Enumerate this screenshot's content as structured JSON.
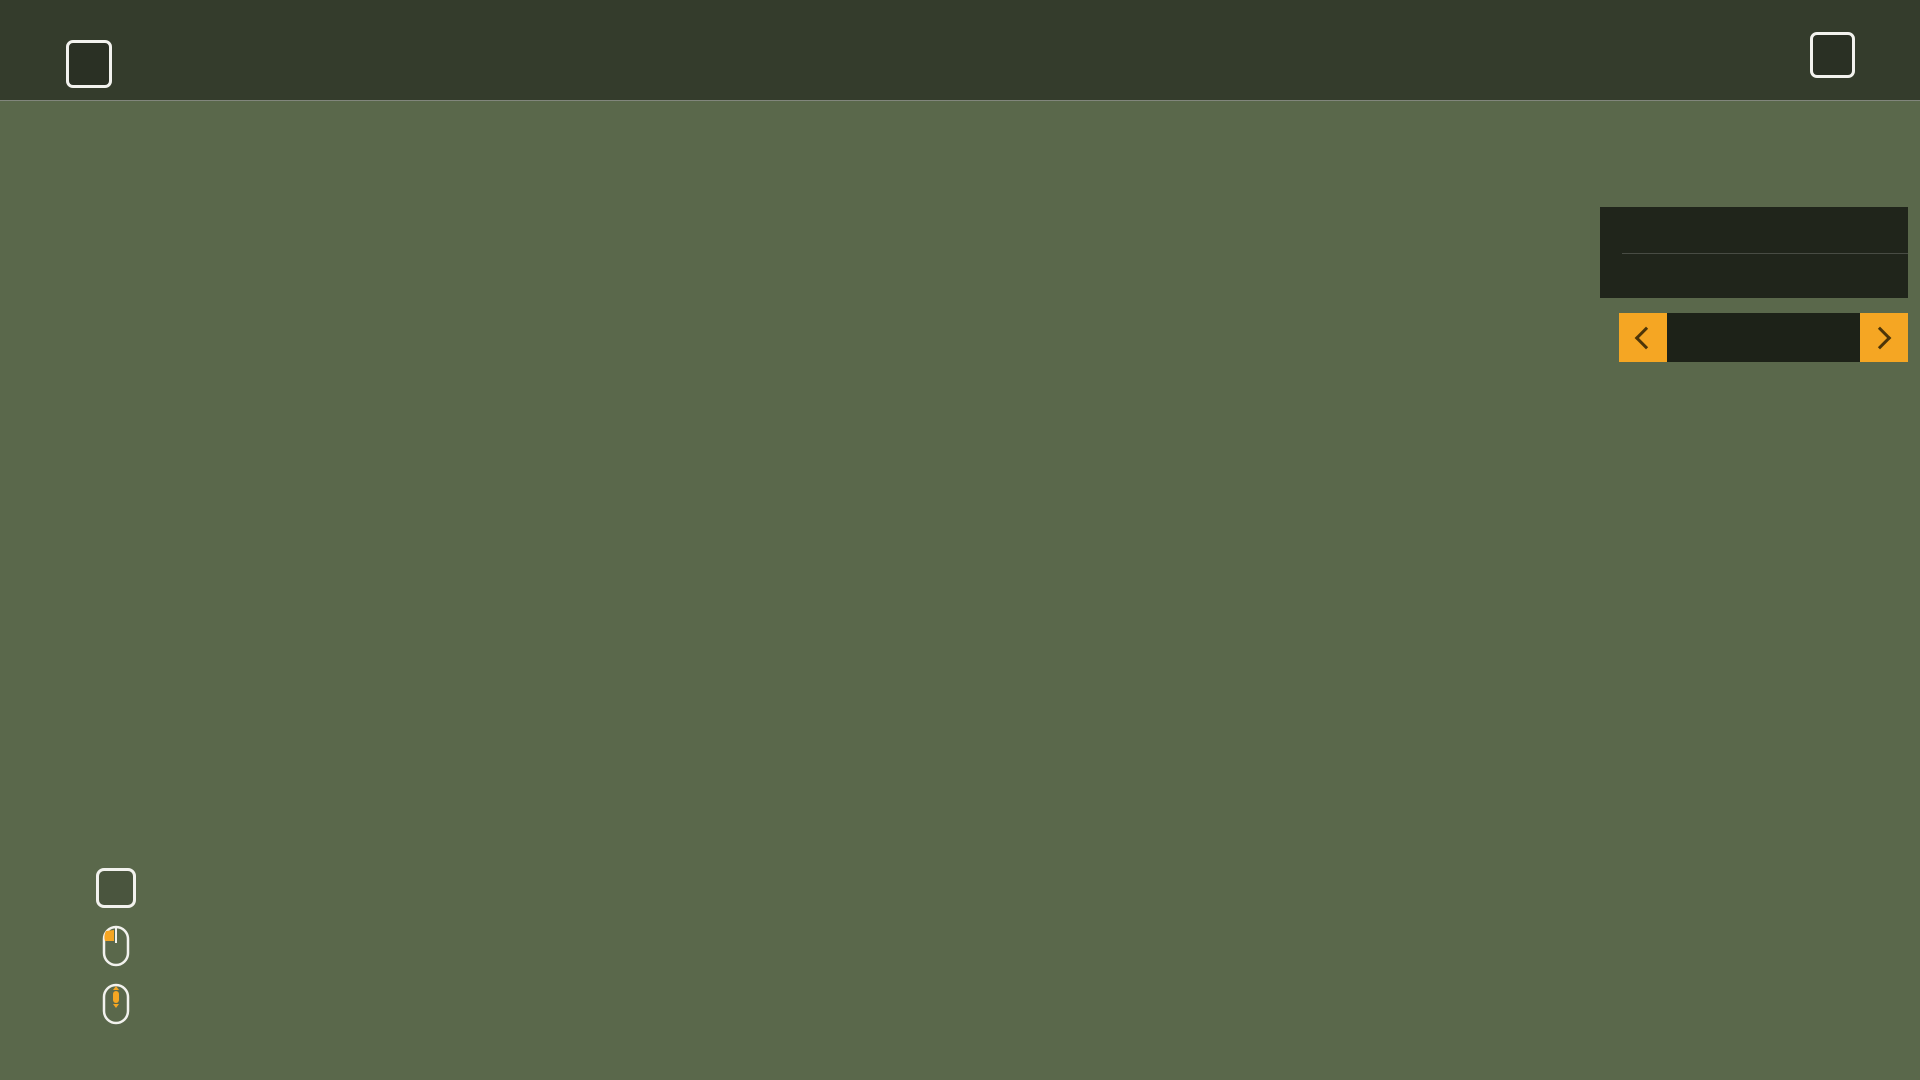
{
  "window": {
    "left_key": "Q",
    "right_key": "E"
  },
  "topbar": {
    "selected_index": 1,
    "tabs": [
      {
        "name": "map",
        "icon": "globe"
      },
      {
        "name": "statistics",
        "icon": "chart"
      },
      {
        "name": "vehicles",
        "icon": "tractor"
      },
      {
        "name": "finances",
        "icon": "dollar"
      },
      {
        "name": "animals",
        "icon": "cow"
      },
      {
        "name": "contracts",
        "icon": "papers"
      },
      {
        "name": "production",
        "icon": "easel"
      },
      {
        "name": "garage",
        "icon": "tractor-gear"
      },
      {
        "name": "display-settings",
        "icon": "monitor-gear"
      },
      {
        "name": "game-settings",
        "icon": "blocks-gear"
      },
      {
        "name": "help",
        "icon": "doc-info"
      }
    ]
  },
  "filter_panel": {
    "title": "FILTRELER",
    "accent": "#f5a623",
    "icon_color": "#eda82d",
    "filter_icons": [
      "tractor",
      "harvester",
      "trailer",
      "gears",
      "download",
      "warning",
      "house"
    ],
    "selector": {
      "label": "Meyve türleri"
    },
    "crops": [
      {
        "label": "Buğday",
        "icon": "wheat",
        "color": "#c9b366",
        "dimmed": false
      },
      {
        "label": "Arpa",
        "icon": "barley",
        "color": "#a98c4a",
        "dimmed": false
      },
      {
        "label": "Yulaf",
        "icon": "oat",
        "color": "#c07830",
        "dimmed": false
      },
      {
        "label": "Pamuk",
        "icon": "cotton",
        "color": "#e8e8e4",
        "dimmed": false
      },
      {
        "label": "Kanola",
        "icon": "canola",
        "color": "#94b83c",
        "dimmed": false
      },
      {
        "label": "Ayçiçekleri",
        "icon": "sunflower",
        "color": "#e8c832",
        "dimmed": false
      },
      {
        "label": "Soya fasulyeleri",
        "icon": "soybean",
        "color": "#8a9838",
        "dimmed": false
      },
      {
        "label": "Mısır",
        "icon": "corn",
        "color": "#e89f35",
        "dimmed": false
      },
      {
        "label": "Patates",
        "icon": "potato",
        "color": "#a87858",
        "dimmed": false
      },
      {
        "label": "Şeker Pancarı",
        "icon": "sugarbeet",
        "color": "#e8b0a0",
        "dimmed": false
      },
      {
        "label": "Yağ Tohumu Turpu",
        "icon": "radish",
        "color": "#58b878",
        "dimmed": false
      },
      {
        "label": "Kavak",
        "icon": "poplar",
        "color": "#9cb39c",
        "dimmed": false
      },
      {
        "label": "Çim",
        "icon": "grass",
        "color": "#c3c7cd",
        "dimmed": true
      },
      {
        "label": "Şeker Kamışı",
        "icon": "sugarcane",
        "color": "#cede96",
        "dimmed": false
      }
    ]
  },
  "legend": {
    "items": [
      {
        "kind": "key",
        "key": "X",
        "label": "TOPRAKLAR"
      },
      {
        "kind": "mouse",
        "mouse": "drag",
        "label": "HARITAYI ÇEVİR"
      },
      {
        "kind": "mouse",
        "mouse": "scroll",
        "label": "HARITAYI YAKINLAŞTIR"
      }
    ]
  },
  "map": {
    "colors": {
      "ground": "#5a684b",
      "water": "#6a85ab",
      "road": "#8f8f8a",
      "road_edge": "#5f5f58",
      "rail": "#454540",
      "tree": "#2c4326",
      "hotspot_bg": "#14140f",
      "gold": "#e8b545",
      "label_white": "#e9e9e4",
      "num_cream": "#f2e3c2",
      "num_grey": "#8f8a82",
      "num_green": "#3ed43e"
    },
    "fields": [
      {
        "number": "6",
        "color": "#e8cd25",
        "points": "450,102 636,102 636,246 512,376 450,376",
        "nx": 541,
        "ny": 190,
        "ncolor": "cream"
      },
      {
        "number": "7",
        "color": "#8b9630",
        "points": "713,102 865,102 865,264 713,264",
        "nx": 788,
        "ny": 152,
        "ncolor": "cream"
      },
      {
        "number": "8",
        "color": "#eda135",
        "points": "305,362 345,362 455,430 455,492 305,492",
        "nx": 375,
        "ny": 460,
        "ncolor": "cream"
      },
      {
        "number": "9",
        "color": "#9a7055",
        "points": "636,308 670,332 670,492 525,492 525,448",
        "nx": 594,
        "ny": 464,
        "ncolor": "cream"
      },
      {
        "number": "10",
        "color": "#dfab9c",
        "points": "695,280 890,280 890,510 695,510",
        "nx": 798,
        "ny": 410,
        "ncolor": "cream"
      },
      {
        "number": "11",
        "color": "#d5b04a",
        "points": "995,323 1068,323 1068,565 995,565",
        "nx": 1032,
        "ny": 450,
        "ncolor": "cream"
      },
      {
        "number": "12",
        "color": "#96825a",
        "points": "1077,203 1317,203 1317,400 1077,400",
        "nx": 1198,
        "ny": 308,
        "ncolor": "cream"
      },
      {
        "number": "13",
        "color": "#c27a33",
        "points": "1080,417 1318,417 1318,557 1080,557",
        "nx": 1195,
        "ny": 492,
        "ncolor": "cream"
      },
      {
        "number": "14",
        "color": "#f5f0e8",
        "points": "1335,293 1447,293 1447,405 1468,405 1468,530 1335,530",
        "nx": 1412,
        "ny": 422,
        "ncolor": "grey"
      },
      {
        "number": "15",
        "color": "#a2cc58",
        "points": "184,737 247,737 247,931 184,931",
        "nx": 218,
        "ny": 840,
        "ncolor": "cream"
      },
      {
        "number": "16",
        "color": "#e6cd2e",
        "points": "307,571 437,571 437,935 307,935",
        "nx": 374,
        "ny": 760,
        "ncolor": "cream"
      },
      {
        "number": "17",
        "color": "#8a9334",
        "points": "526,516 692,516 692,696 526,696",
        "nx": 611,
        "ny": 612,
        "ncolor": "cream"
      },
      {
        "number": "18",
        "color": "#ec9d31",
        "points": "710,504 796,504 796,719 710,719",
        "nx": 755,
        "ny": 612,
        "ncolor": "cream"
      },
      {
        "number": "19",
        "color": "#d2a83e",
        "points": "820,548 900,548 900,770 820,770",
        "nx": 858,
        "ny": 656,
        "ncolor": "green"
      },
      {
        "number": "20",
        "color": "#9b6b55",
        "points": "1008,609 1117,609 1117,803 1008,803",
        "nx": 1065,
        "ny": 716,
        "ncolor": "cream"
      },
      {
        "number": "21",
        "color": "#e7ae9c",
        "points": "1135,596 1362,594 1256,790 1135,792",
        "nx": 1223,
        "ny": 702,
        "ncolor": "cream"
      },
      {
        "number": "22",
        "color": "#dcb24a",
        "points": "1456,592 1580,592 1518,750 1350,750",
        "nx": 1462,
        "ny": 682,
        "ncolor": "cream"
      },
      {
        "number": "23",
        "color": "#8a5a40",
        "points": "1660,668 1888,668 1888,912 1660,912",
        "nx": 1706,
        "ny": 762,
        "ncolor": "grey"
      },
      {
        "number": "24",
        "color": "#c8772e",
        "points": "565,848 599,848 599,974 514,974 514,908",
        "nx": 557,
        "ny": 936,
        "ncolor": "cream"
      },
      {
        "number": "25",
        "color": "#efeae6",
        "points": "609,816 712,816 712,931 609,931",
        "nx": 659,
        "ny": 886,
        "ncolor": "grey"
      },
      {
        "number": "26",
        "color": "#7aa43c",
        "points": "728,785 833,785 833,945 728,945",
        "nx": 779,
        "ny": 878,
        "ncolor": "cream",
        "stroke": "#a8cc66"
      },
      {
        "number": "27",
        "color": "#e8cc28",
        "points": "937,830 994,830 994,948 937,948",
        "nx": 965,
        "ny": 894,
        "ncolor": "cream"
      },
      {
        "number": "28",
        "color": "#a0a02a",
        "points": "1001,882 1080,882 1080,948 1001,948",
        "nx": 1040,
        "ny": 920,
        "ncolor": "cream"
      },
      {
        "number": "29",
        "color": "#96766a",
        "points": "1308,778 1472,778 1472,857 1308,857",
        "nx": 1388,
        "ny": 822,
        "ncolor": "cream"
      },
      {
        "number": "30",
        "color": "#9a6a52",
        "points": "1308,882 1472,882 1472,968 1308,968",
        "nx": 1390,
        "ny": 932,
        "ncolor": "cream"
      }
    ],
    "labels": [
      {
        "text": "Tahıl Değirmeni",
        "x": 1424,
        "y": 250,
        "color": "gold",
        "size": 24,
        "anchor": "start"
      },
      {
        "text": "Batı Demiryolu Silosu",
        "x": 152,
        "y": 714,
        "color": "gold",
        "size": 23,
        "anchor": "start"
      },
      {
        "text": "Samanlık",
        "x": 446,
        "y": 1009,
        "color": "gold",
        "size": 24,
        "anchor": "middle"
      },
      {
        "text": "Hayvan satıcısı",
        "x": 450,
        "y": 958,
        "color": "white",
        "size": 24,
        "anchor": "middle"
      },
      {
        "text": "Mağaza",
        "x": 1222,
        "y": 1002,
        "color": "white",
        "size": 24,
        "anchor": "middle"
      }
    ],
    "hotspots": [
      {
        "type": "sell-point",
        "icon": "down-arrow-gold",
        "x": 1503,
        "y": 277,
        "r": 19
      },
      {
        "type": "fuel-station",
        "icon": "fuel-pump",
        "x": 1497,
        "y": 361,
        "r": 15
      },
      {
        "type": "sell-point",
        "icon": "down-arrow-gold",
        "x": 277,
        "y": 664,
        "r": 19
      },
      {
        "type": "animal-dealer",
        "icon": "cow",
        "x": 447,
        "y": 920,
        "r": 20
      },
      {
        "type": "sell-point",
        "icon": "down-arrow-gold",
        "x": 444,
        "y": 968,
        "r": 18
      },
      {
        "type": "shop",
        "icon": "basket",
        "x": 1219,
        "y": 984,
        "r": 18
      },
      {
        "type": "sell-point-sq",
        "icon": "down-arrow-gold",
        "x": 1771,
        "y": 1056,
        "r": 19
      },
      {
        "type": "farm-silo",
        "icon": "down-arrow-white",
        "x": 935,
        "y": 522,
        "r": 15
      },
      {
        "type": "farm-fuel",
        "icon": "fuel-pump",
        "x": 965,
        "y": 557,
        "r": 15
      },
      {
        "type": "farm-house",
        "icon": "house",
        "x": 957,
        "y": 590,
        "r": 15
      },
      {
        "type": "farm-house-2",
        "icon": "house-down",
        "x": 954,
        "y": 613,
        "r": 15
      },
      {
        "type": "barn-pig",
        "icon": "barn",
        "x": 940,
        "y": 646,
        "r": 16
      },
      {
        "type": "barn-horse",
        "icon": "barn",
        "x": 930,
        "y": 685,
        "r": 16
      },
      {
        "type": "barn-sheep",
        "icon": "barn",
        "x": 922,
        "y": 723,
        "r": 16
      },
      {
        "type": "barn-cow",
        "icon": "barn",
        "x": 927,
        "y": 769,
        "r": 16
      },
      {
        "type": "player-marker",
        "icon": "green-ring",
        "x": 890,
        "y": 566,
        "r": 9
      }
    ]
  }
}
